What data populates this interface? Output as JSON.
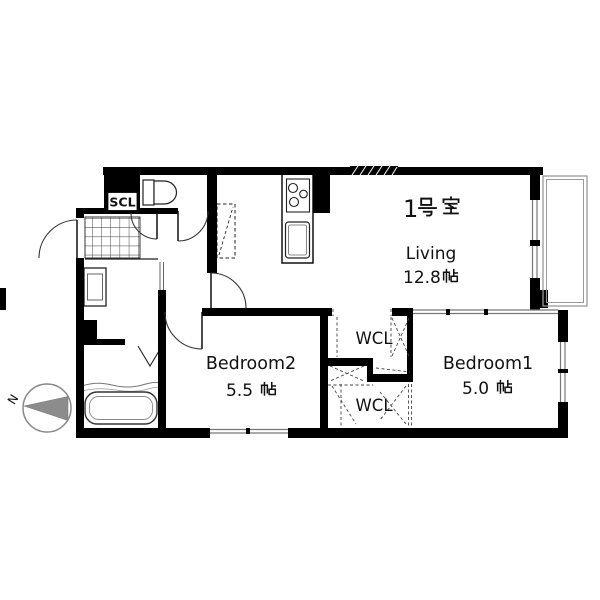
{
  "floorplan": {
    "unit": {
      "number": "1",
      "suffix": "号室",
      "full": "1号室"
    },
    "rooms": {
      "living": {
        "name": "Living",
        "area_value": "12.8",
        "area_unit": "帖",
        "area": "12.8帖"
      },
      "bedroom2": {
        "name": "Bedroom2",
        "area_value": "5.5",
        "area_unit": "帖",
        "area": "5.5帖"
      },
      "bedroom1": {
        "name": "Bedroom1",
        "area_value": "5.0",
        "area_unit": "帖",
        "area": "5.0帖"
      }
    },
    "closets": {
      "wcl_upper": "WCL",
      "wcl_lower": "WCL",
      "scl": "SCL"
    },
    "compass": {
      "north": "N"
    },
    "colors": {
      "wall": "#000000",
      "window_line": "#777777",
      "balcony_line": "#999999",
      "compass_fill": "#8c8c8c"
    }
  }
}
